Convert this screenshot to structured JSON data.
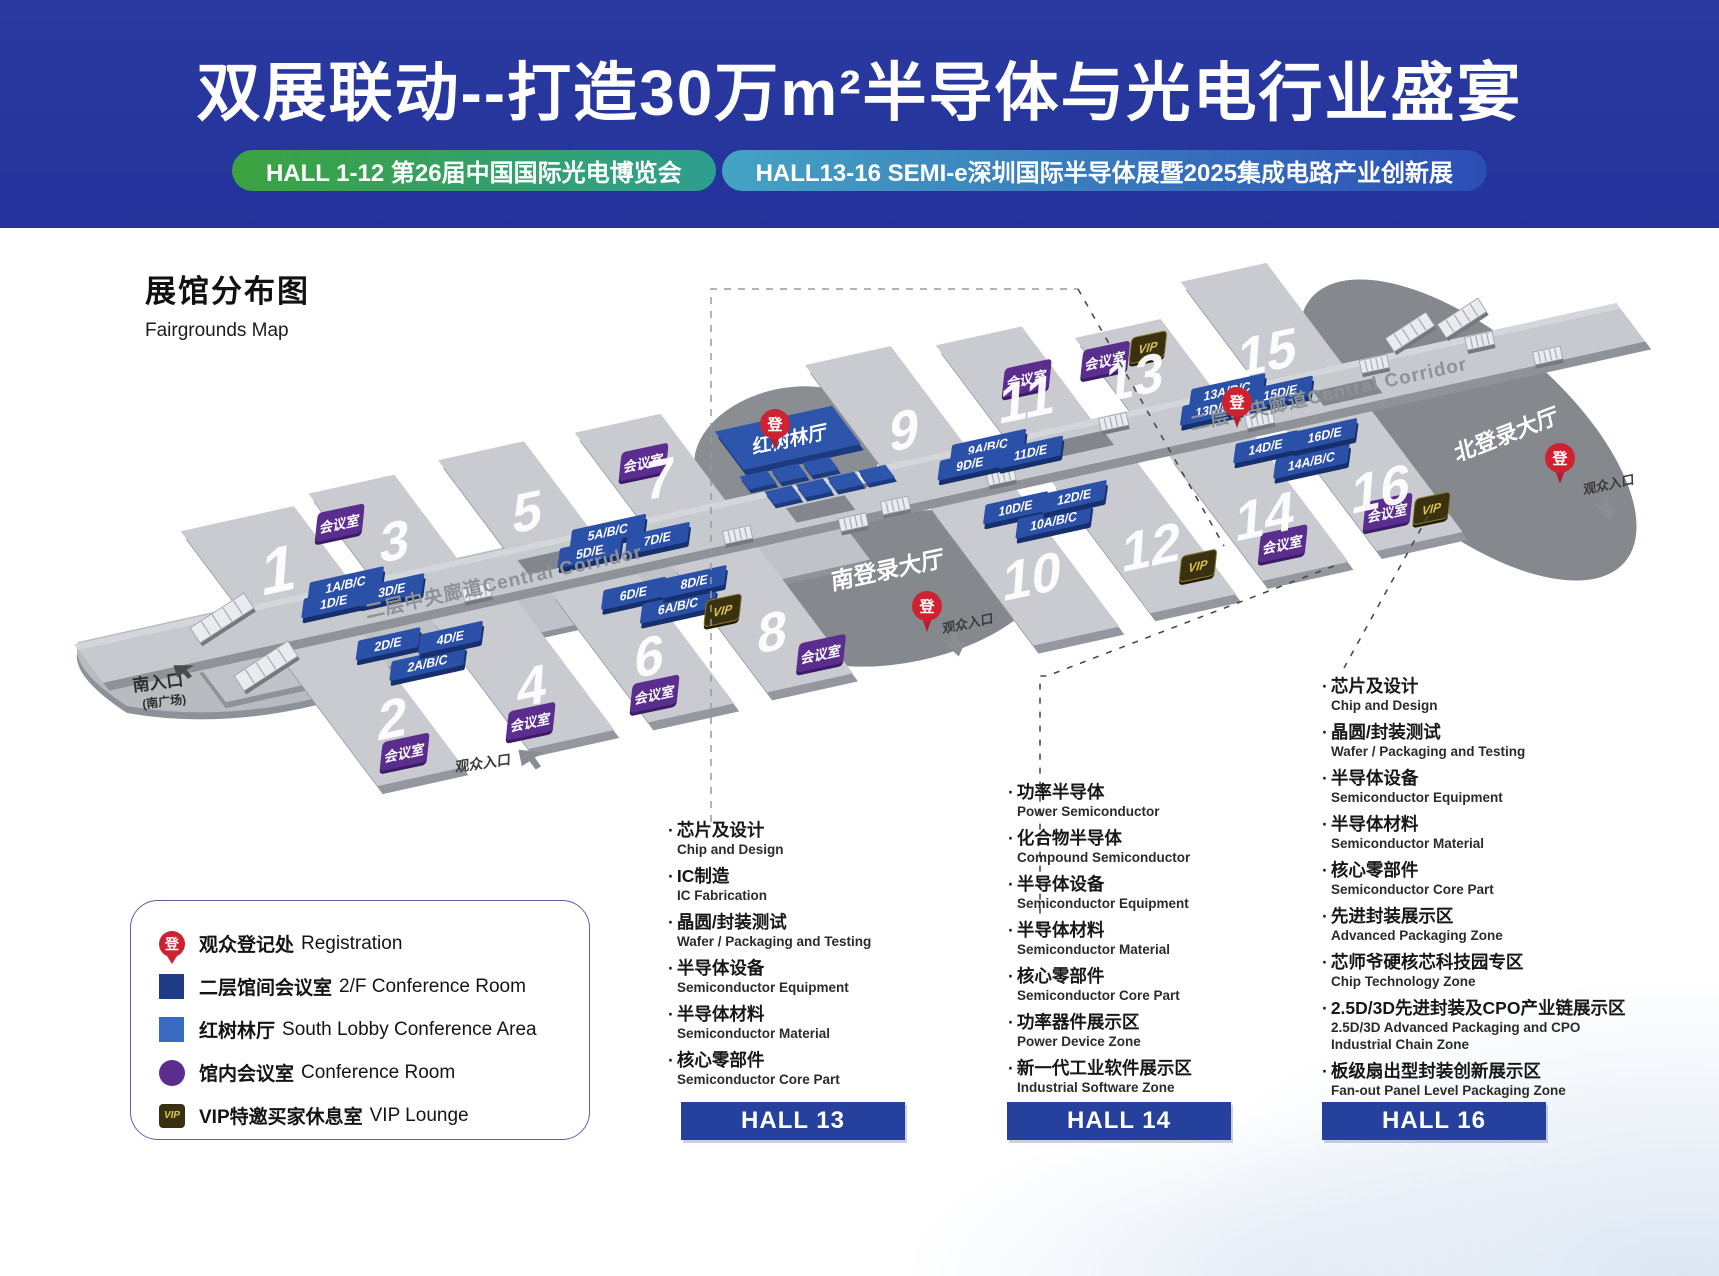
{
  "header": {
    "title": "双展联动--打造30万m²半导体与光电行业盛宴",
    "badge_left": "HALL 1-12  第26届中国国际光电博览会",
    "badge_right": "HALL13-16  SEMI-e深圳国际半导体展暨2025集成电路产业创新展"
  },
  "map": {
    "title_zh": "展馆分布图",
    "title_en": "Fairgrounds Map",
    "corridor_label": "二层中央廊道Central Corridor",
    "registration_glyph": "登",
    "meeting_room_label": "会议室",
    "vip_label": "VIP",
    "halls": [
      "1",
      "2",
      "3",
      "4",
      "5",
      "6",
      "7",
      "8",
      "9",
      "10",
      "11",
      "12",
      "13",
      "14",
      "15",
      "16"
    ],
    "corridor_rooms": [
      "1A/B/C",
      "1D/E",
      "3D/E",
      "5A/B/C",
      "5D/E",
      "7D/E",
      "9A/B/C",
      "9D/E",
      "11D/E",
      "13A/B/C",
      "13D/E",
      "15D/E",
      "2D/E",
      "2A/B/C",
      "4D/E",
      "6D/E",
      "6A/B/C",
      "8D/E",
      "10D/E",
      "10A/B/C",
      "12D/E",
      "14D/E",
      "14A/B/C",
      "16D/E"
    ],
    "lobbies": {
      "mangrove": "红树林厅",
      "south": "南登录大厅",
      "north": "北登录大厅"
    },
    "entrances": {
      "south_zh": "南入口",
      "south_sub": "(南广场)",
      "visitor": "观众入口"
    }
  },
  "legend": {
    "items": [
      {
        "icon": "pin",
        "zh": "观众登记处",
        "en": "Registration"
      },
      {
        "icon": "navy",
        "zh": "二层馆间会议室",
        "en": "2/F Conference Room"
      },
      {
        "icon": "blue",
        "zh": "红树林厅",
        "en": "South Lobby Conference Area"
      },
      {
        "icon": "purple",
        "zh": "馆内会议室",
        "en": "Conference Room"
      },
      {
        "icon": "vip",
        "zh": "VIP特邀买家休息室",
        "en": "VIP Lounge"
      }
    ]
  },
  "sections": [
    {
      "banner": "HALL 13",
      "items": [
        {
          "zh": "芯片及设计",
          "en": "Chip and Design"
        },
        {
          "zh": "IC制造",
          "en": "IC Fabrication"
        },
        {
          "zh": "晶圆/封装测试",
          "en": "Wafer / Packaging and Testing"
        },
        {
          "zh": "半导体设备",
          "en": "Semiconductor Equipment"
        },
        {
          "zh": "半导体材料",
          "en": "Semiconductor Material"
        },
        {
          "zh": "核心零部件",
          "en": "Semiconductor Core Part"
        }
      ]
    },
    {
      "banner": "HALL 14",
      "items": [
        {
          "zh": "功率半导体",
          "en": "Power Semiconductor"
        },
        {
          "zh": "化合物半导体",
          "en": "Compound Semiconductor"
        },
        {
          "zh": "半导体设备",
          "en": "Semiconductor Equipment"
        },
        {
          "zh": "半导体材料",
          "en": "Semiconductor Material"
        },
        {
          "zh": "核心零部件",
          "en": "Semiconductor Core Part"
        },
        {
          "zh": "功率器件展示区",
          "en": "Power Device Zone"
        },
        {
          "zh": "新一代工业软件展示区",
          "en": "Industrial Software Zone"
        }
      ]
    },
    {
      "banner": "HALL 16",
      "items": [
        {
          "zh": "芯片及设计",
          "en": "Chip and Design"
        },
        {
          "zh": "晶圆/封装测试",
          "en": "Wafer / Packaging and Testing"
        },
        {
          "zh": "半导体设备",
          "en": "Semiconductor Equipment"
        },
        {
          "zh": "半导体材料",
          "en": "Semiconductor Material"
        },
        {
          "zh": "核心零部件",
          "en": "Semiconductor Core Part"
        },
        {
          "zh": "先进封装展示区",
          "en": "Advanced Packaging Zone"
        },
        {
          "zh": "芯师爷硬核芯科技园专区",
          "en": "Chip Technology Zone"
        },
        {
          "zh": "2.5D/3D先进封装及CPO产业链展示区",
          "en": "2.5D/3D Advanced Packaging and CPO Industrial Chain Zone"
        },
        {
          "zh": "板级扇出型封装创新展示区",
          "en": "Fan-out Panel Level Packaging Zone"
        }
      ]
    }
  ],
  "colors": {
    "header_bg": "#24339B",
    "hall_banner_bg": "#26409D",
    "pill_left": [
      "#3BA23E",
      "#2E9F90"
    ],
    "pill_right": [
      "#45A3C4",
      "#2B4EB5"
    ],
    "hall_slab": "#C9CBD0",
    "corridor": "#C6C9CE",
    "lobby_dark": "#85888D",
    "room_blue": "#2B50A8",
    "meeting_purple": "#5B2D8E",
    "vip_bg": "#3A3110",
    "vip_text": "#DCC258",
    "registration_red": "#CE2231"
  }
}
